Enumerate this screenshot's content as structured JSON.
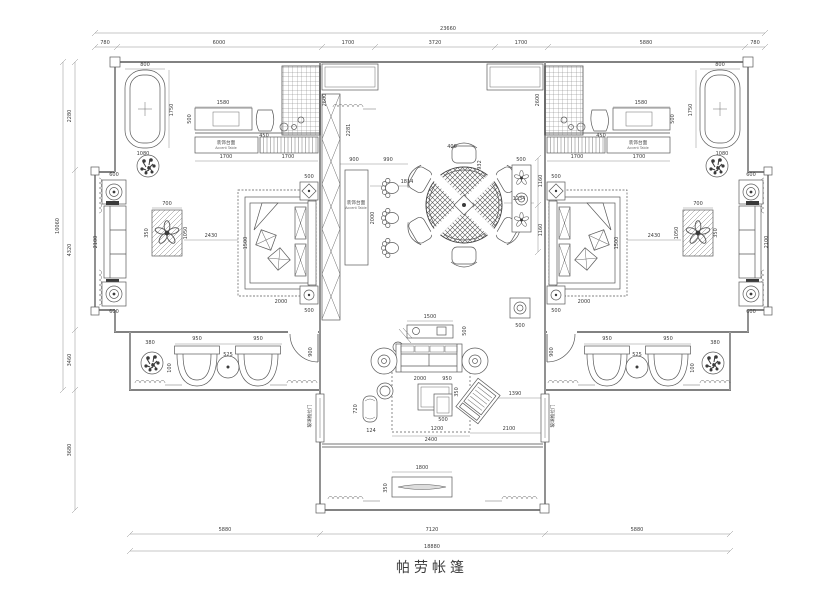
{
  "title": "帕劳帐篷",
  "drawing_type": "floor-plan",
  "dimensions": {
    "top_total": "23660",
    "top_chain": [
      "780",
      "6000",
      "1700",
      "3720",
      "1700",
      "5880",
      "780"
    ],
    "bottom_chain": [
      "5880",
      "7120",
      "5880"
    ],
    "bottom_total": "18880",
    "left_chain": [
      "2280",
      "4320",
      "3460",
      "3680"
    ],
    "left_total": "10060"
  },
  "text_labels": [
    {
      "cn": "装饰台面",
      "en": "Accent Table",
      "x": 226,
      "y": 144
    },
    {
      "cn": "装饰台面",
      "en": "Accent Table",
      "x": 638,
      "y": 144
    },
    {
      "cn": "装饰台面",
      "en": "Accent Table",
      "x": 356,
      "y": 204
    },
    {
      "cn": "玻璃推拉门",
      "x": 311,
      "y": 416,
      "r": -90
    },
    {
      "cn": "玻璃推拉门",
      "x": 554,
      "y": 416,
      "r": -90
    }
  ],
  "annotations": [
    {
      "t": "23660",
      "x": 448,
      "y": 30
    },
    {
      "t": "780",
      "x": 105,
      "y": 44
    },
    {
      "t": "6000",
      "x": 219,
      "y": 44
    },
    {
      "t": "1700",
      "x": 348,
      "y": 44
    },
    {
      "t": "3720",
      "x": 435,
      "y": 44
    },
    {
      "t": "1700",
      "x": 521,
      "y": 44
    },
    {
      "t": "5880",
      "x": 646,
      "y": 44
    },
    {
      "t": "780",
      "x": 755,
      "y": 44
    },
    {
      "t": "5880",
      "x": 225,
      "y": 531
    },
    {
      "t": "7120",
      "x": 432,
      "y": 531
    },
    {
      "t": "5880",
      "x": 637,
      "y": 531
    },
    {
      "t": "18880",
      "x": 432,
      "y": 548
    },
    {
      "t": "2280",
      "x": 71,
      "y": 116,
      "r": -90
    },
    {
      "t": "4320",
      "x": 71,
      "y": 250,
      "r": -90
    },
    {
      "t": "3460",
      "x": 71,
      "y": 360,
      "r": -90
    },
    {
      "t": "3680",
      "x": 71,
      "y": 450,
      "r": -90
    },
    {
      "t": "10060",
      "x": 59,
      "y": 226,
      "r": -90
    },
    {
      "t": "800",
      "x": 145,
      "y": 66
    },
    {
      "t": "1750",
      "x": 173,
      "y": 110,
      "r": -90
    },
    {
      "t": "1080",
      "x": 143,
      "y": 155
    },
    {
      "t": "1580",
      "x": 223,
      "y": 104
    },
    {
      "t": "500",
      "x": 191,
      "y": 119,
      "r": -90
    },
    {
      "t": "450",
      "x": 264,
      "y": 137
    },
    {
      "t": "2600",
      "x": 326,
      "y": 100,
      "r": -90
    },
    {
      "t": "1700",
      "x": 226,
      "y": 158
    },
    {
      "t": "1700",
      "x": 288,
      "y": 158
    },
    {
      "t": "700",
      "x": 167,
      "y": 205
    },
    {
      "t": "1050",
      "x": 187,
      "y": 233,
      "r": -90
    },
    {
      "t": "350",
      "x": 148,
      "y": 233,
      "r": -90
    },
    {
      "t": "2430",
      "x": 211,
      "y": 237
    },
    {
      "t": "1500",
      "x": 247,
      "y": 243,
      "r": -90
    },
    {
      "t": "2000",
      "x": 281,
      "y": 303
    },
    {
      "t": "500",
      "x": 309,
      "y": 178
    },
    {
      "t": "500",
      "x": 309,
      "y": 312
    },
    {
      "t": "600",
      "x": 114,
      "y": 176
    },
    {
      "t": "600",
      "x": 114,
      "y": 313
    },
    {
      "t": "2100",
      "x": 97,
      "y": 242,
      "r": -90
    },
    {
      "t": "380",
      "x": 150,
      "y": 344
    },
    {
      "t": "950",
      "x": 197,
      "y": 340
    },
    {
      "t": "950",
      "x": 258,
      "y": 340
    },
    {
      "t": "525",
      "x": 228,
      "y": 356
    },
    {
      "t": "100",
      "x": 171,
      "y": 368,
      "r": -90
    },
    {
      "t": "900",
      "x": 312,
      "y": 352,
      "r": -90
    },
    {
      "t": "2281",
      "x": 350,
      "y": 130,
      "r": -90
    },
    {
      "t": "900",
      "x": 354,
      "y": 161
    },
    {
      "t": "990",
      "x": 388,
      "y": 161
    },
    {
      "t": "2000",
      "x": 374,
      "y": 218,
      "r": -90
    },
    {
      "t": "1814",
      "x": 407,
      "y": 183
    },
    {
      "t": "400",
      "x": 452,
      "y": 148
    },
    {
      "t": "932",
      "x": 481,
      "y": 165,
      "r": -90
    },
    {
      "t": "1234",
      "x": 519,
      "y": 200
    },
    {
      "t": "1160",
      "x": 542,
      "y": 181,
      "r": -90
    },
    {
      "t": "1160",
      "x": 542,
      "y": 230,
      "r": -90
    },
    {
      "t": "500",
      "x": 521,
      "y": 161
    },
    {
      "t": "500",
      "x": 520,
      "y": 327
    },
    {
      "t": "1500",
      "x": 430,
      "y": 318
    },
    {
      "t": "500",
      "x": 466,
      "y": 331,
      "r": -90
    },
    {
      "t": "2000",
      "x": 420,
      "y": 380
    },
    {
      "t": "950",
      "x": 447,
      "y": 380
    },
    {
      "t": "350",
      "x": 458,
      "y": 392,
      "r": -90
    },
    {
      "t": "500",
      "x": 443,
      "y": 421
    },
    {
      "t": "1200",
      "x": 437,
      "y": 430
    },
    {
      "t": "720",
      "x": 357,
      "y": 409,
      "r": -90
    },
    {
      "t": "124",
      "x": 371,
      "y": 432
    },
    {
      "t": "1390",
      "x": 515,
      "y": 395
    },
    {
      "t": "2100",
      "x": 509,
      "y": 430
    },
    {
      "t": "2400",
      "x": 431,
      "y": 441
    },
    {
      "t": "1800",
      "x": 422,
      "y": 469
    },
    {
      "t": "350",
      "x": 387,
      "y": 488,
      "r": -90
    },
    {
      "t": "800",
      "x": 720,
      "y": 66
    },
    {
      "t": "1750",
      "x": 692,
      "y": 110,
      "r": -90
    },
    {
      "t": "1080",
      "x": 722,
      "y": 155
    },
    {
      "t": "1580",
      "x": 641,
      "y": 104
    },
    {
      "t": "500",
      "x": 674,
      "y": 119,
      "r": -90
    },
    {
      "t": "450",
      "x": 601,
      "y": 137
    },
    {
      "t": "2600",
      "x": 539,
      "y": 100,
      "r": -90
    },
    {
      "t": "1700",
      "x": 577,
      "y": 158
    },
    {
      "t": "1700",
      "x": 639,
      "y": 158
    },
    {
      "t": "700",
      "x": 698,
      "y": 205
    },
    {
      "t": "1050",
      "x": 678,
      "y": 233,
      "r": -90
    },
    {
      "t": "350",
      "x": 717,
      "y": 233,
      "r": -90
    },
    {
      "t": "2430",
      "x": 654,
      "y": 237
    },
    {
      "t": "1500",
      "x": 618,
      "y": 243,
      "r": -90
    },
    {
      "t": "2000",
      "x": 584,
      "y": 303
    },
    {
      "t": "500",
      "x": 556,
      "y": 178
    },
    {
      "t": "500",
      "x": 556,
      "y": 312
    },
    {
      "t": "600",
      "x": 751,
      "y": 176
    },
    {
      "t": "600",
      "x": 751,
      "y": 313
    },
    {
      "t": "2100",
      "x": 768,
      "y": 242,
      "r": -90
    },
    {
      "t": "380",
      "x": 715,
      "y": 344
    },
    {
      "t": "950",
      "x": 607,
      "y": 340
    },
    {
      "t": "950",
      "x": 668,
      "y": 340
    },
    {
      "t": "525",
      "x": 637,
      "y": 356
    },
    {
      "t": "100",
      "x": 694,
      "y": 368,
      "r": -90
    },
    {
      "t": "900",
      "x": 553,
      "y": 352,
      "r": -90
    }
  ]
}
